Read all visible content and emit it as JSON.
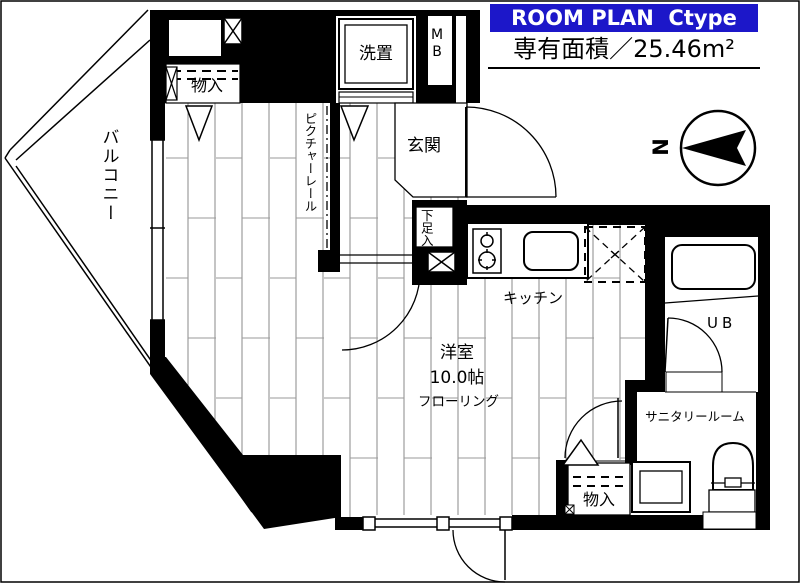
{
  "header": {
    "title": "ROOM PLAN  Ctype",
    "area_label": "専有面積／25.46m²"
  },
  "compass": {
    "north_label": "N"
  },
  "rooms": {
    "balcony": "バルコニー",
    "entrance": "玄関",
    "western_room_name": "洋室",
    "western_room_size": "10.0帖",
    "western_room_floor": "フローリング",
    "kitchen": "キッチン",
    "unit_bath": "UB",
    "sanitary_room": "サニタリールーム",
    "picture_rail": "ピクチャーレール"
  },
  "fixtures": {
    "storage_top": "物入",
    "storage_bottom": "物入",
    "washer_space": "洗置",
    "meter_box": "MB",
    "shoe_box": "下足入"
  },
  "colors": {
    "title_bg": "#1c17c9",
    "title_text": "#ffffff",
    "wall": "#000000",
    "floor_line": "#8a8a8a"
  }
}
